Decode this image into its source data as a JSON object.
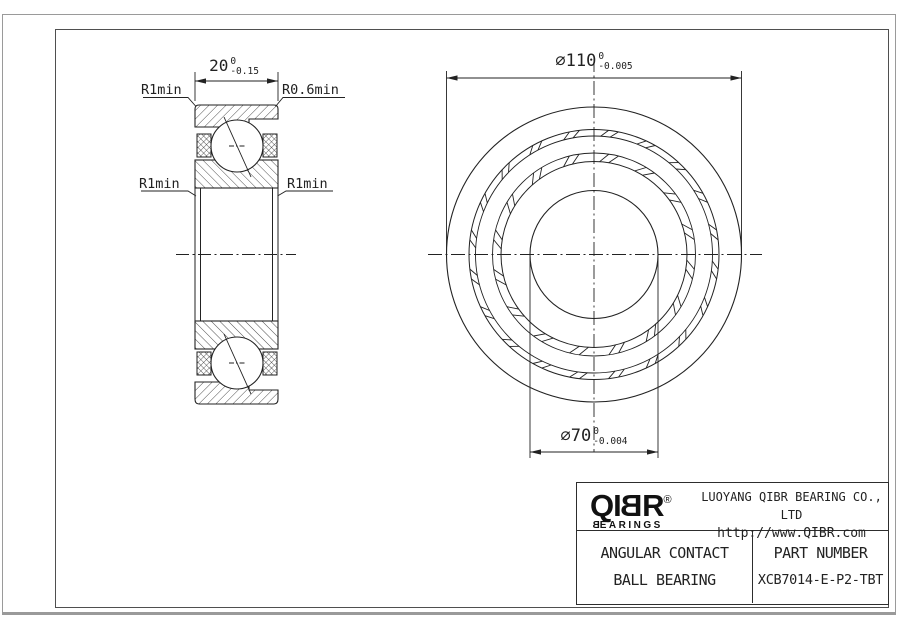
{
  "colors": {
    "line": "#222222",
    "frame_outer": "#9a9a9a",
    "frame_inner": "#4f4f4f",
    "background": "#ffffff"
  },
  "section_view": {
    "width_dim": {
      "value": "20",
      "tol_upper": "0",
      "tol_lower": "-0.15"
    },
    "leader_labels": {
      "top_left": "R1min",
      "top_right": "R0.6min",
      "mid_left": "R1min",
      "mid_right": "R1min"
    }
  },
  "front_view": {
    "outer_dia_dim": {
      "symbol": "⌀",
      "value": "110",
      "tol_upper": "0",
      "tol_lower": "-0.005"
    },
    "bore_dia_dim": {
      "symbol": "⌀",
      "value": "70",
      "tol_upper": "0",
      "tol_lower": "-0.004"
    }
  },
  "title_block": {
    "logo": {
      "l1": "Q",
      "l2": "I",
      "l3": "B",
      "l4": "R",
      "registered": "®",
      "sub_first": "B",
      "sub_rest": "EARINGS"
    },
    "company_name": "LUOYANG QIBR BEARING CO., LTD",
    "website": "http://www.QIBR.com",
    "product_type_line1": "ANGULAR CONTACT",
    "product_type_line2": "BALL BEARING",
    "part_number_label": "PART NUMBER",
    "part_number": "XCB7014-E-P2-TBT"
  }
}
